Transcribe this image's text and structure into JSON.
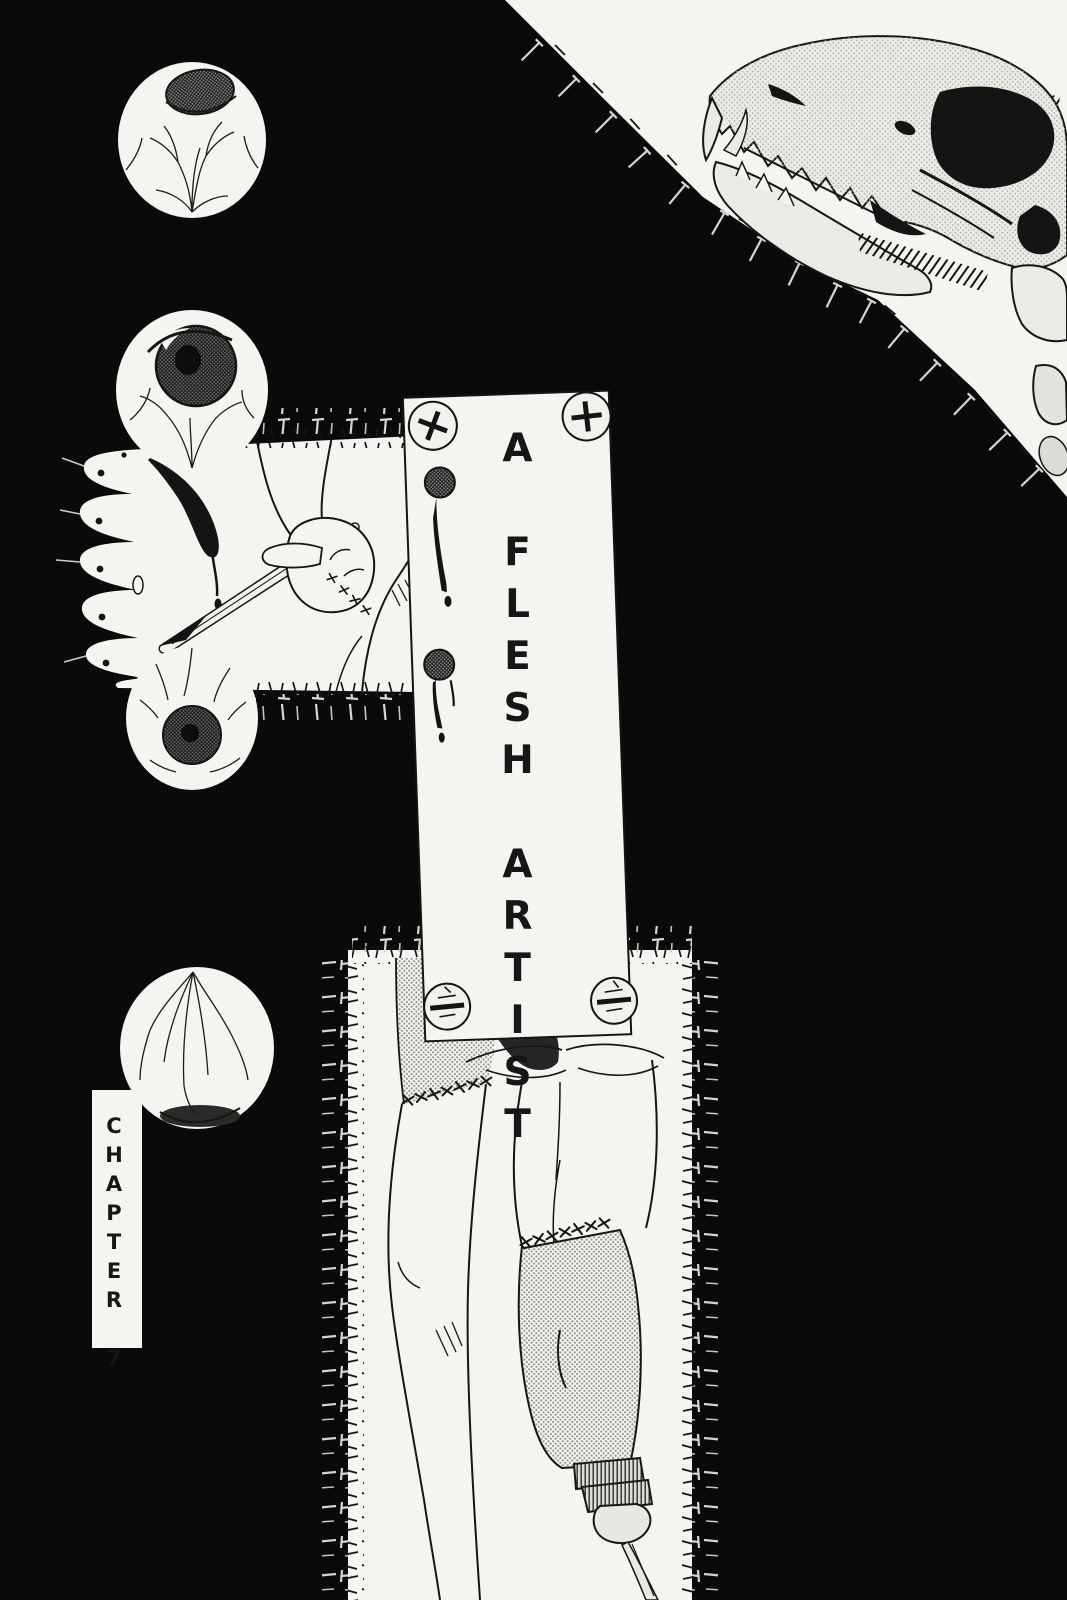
{
  "page": {
    "kind": "manga chapter title page",
    "background_color": "#0a0a0a",
    "paper_color": "#f5f4f0",
    "ink_color": "#161616",
    "tone_color": "#8f8e8a"
  },
  "title": {
    "text": "A FLESH ARTIST"
  },
  "chapter": {
    "text": "CHAPTER 7"
  },
  "illustrations": [
    {
      "name": "eyeball-top-iris"
    },
    {
      "name": "eyeball-three-quarter-iris"
    },
    {
      "name": "eyeball-front-iris"
    },
    {
      "name": "eyeball-back-veins"
    },
    {
      "name": "canine-skull-open-jaw"
    },
    {
      "name": "stitched-flesh-patch-hand-scalpel"
    },
    {
      "name": "nailed-paper-sign"
    },
    {
      "name": "stitched-skin-panel-legs-prosthetic-spike"
    },
    {
      "name": "chapter-label-strip"
    }
  ]
}
